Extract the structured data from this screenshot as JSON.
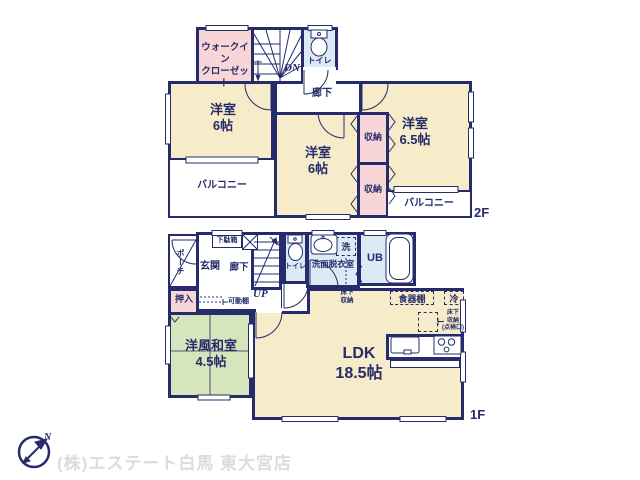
{
  "meta": {
    "company": "(株)エステート白馬 東大宮店",
    "compass_north": "N"
  },
  "colors": {
    "wall": "#252b6b",
    "room_beige": "#f6ecca",
    "closet_pink": "#f8d6d8",
    "wet_area_blue": "#dceaf5",
    "tatami_green": "#d6e5bb",
    "company_text": "#dcdcdc"
  },
  "floor_2f": {
    "label": "2F",
    "rooms": {
      "walk_in_closet": "ウォークイン\nクローゼット",
      "stairs_down": "DN",
      "toilet": "トイレ",
      "hallway": "廊下",
      "bedroom_left": "洋室\n6帖",
      "bedroom_middle": "洋室\n6帖",
      "bedroom_right": "洋室\n6.5帖",
      "closet_upper": "収納",
      "closet_lower": "収納",
      "balcony_left": "バルコニー",
      "balcony_right": "バルコニー"
    }
  },
  "floor_1f": {
    "label": "1F",
    "rooms": {
      "porch": "ポーチ",
      "shoe_cabinet": "下駄箱",
      "entrance": "玄関",
      "hallway": "廊下",
      "stairs_up": "UP",
      "toilet": "トイレ",
      "washroom": "洗面脱衣室",
      "washer": "洗",
      "unit_bath": "UB",
      "futon_closet": "押入",
      "movable_shelf": "可動棚",
      "underfloor_storage": "床下\n収納",
      "japanese_room": "洋風和室\n4.5帖",
      "ldk": "LDK\n18.5帖",
      "cupboard": "食器棚",
      "refrigerator": "冷",
      "underfloor_storage_hatch": "床下\n収納\n(点検口)"
    }
  }
}
